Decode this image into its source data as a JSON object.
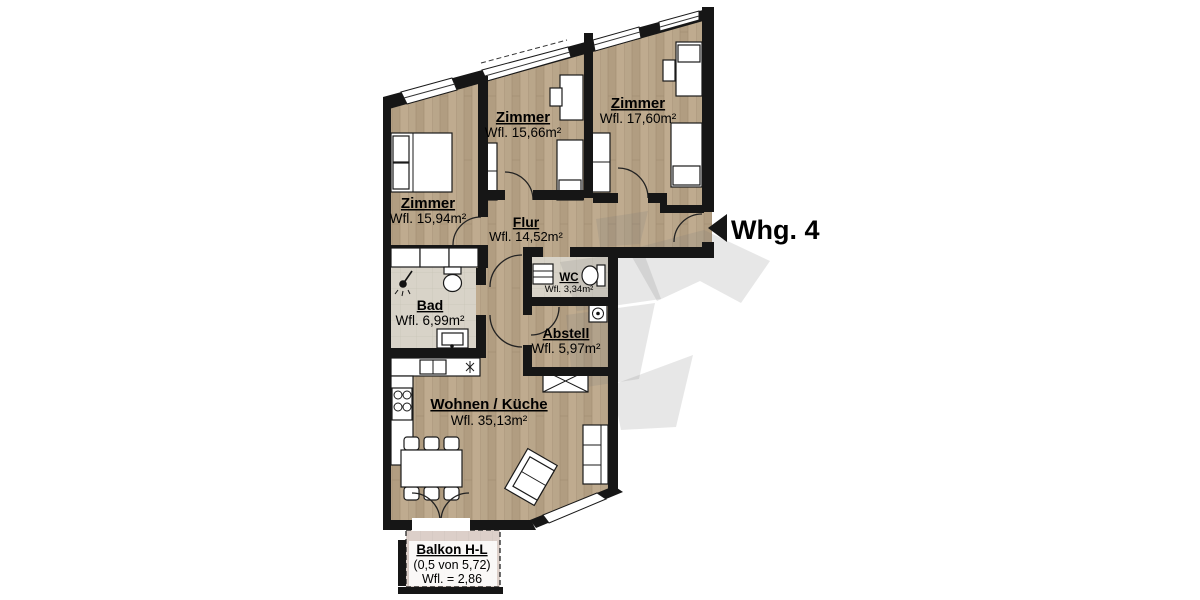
{
  "plan": {
    "entrance": {
      "label": "Whg. 4"
    },
    "rooms": [
      {
        "id": "zimmer-left",
        "name": "Zimmer",
        "area": "Wfl. 15,94m²"
      },
      {
        "id": "zimmer-middle",
        "name": "Zimmer",
        "area": "Wfl. 15,66m²"
      },
      {
        "id": "zimmer-right",
        "name": "Zimmer",
        "area": "Wfl. 17,60m²"
      },
      {
        "id": "flur",
        "name": "Flur",
        "area": "Wfl. 14,52m²"
      },
      {
        "id": "wc",
        "name": "WC",
        "area": "Wfl. 3,34m²"
      },
      {
        "id": "bad",
        "name": "Bad",
        "area": "Wfl. 6,99m²"
      },
      {
        "id": "abstell",
        "name": "Abstell",
        "area": "Wfl. 5,97m²"
      },
      {
        "id": "wohnen-kueche",
        "name": "Wohnen / Küche",
        "area": "Wfl. 35,13m²"
      }
    ],
    "balcony": {
      "name": "Balkon H-L",
      "calc": "(0,5 von 5,72)",
      "area": "Wfl. = 2,86"
    },
    "colors": {
      "wall": "#161616",
      "floor_wood": "#b7a388",
      "tile": "#d8d3c8",
      "balcony": "#dccfc9",
      "watermark": "#7a7a7a"
    }
  }
}
